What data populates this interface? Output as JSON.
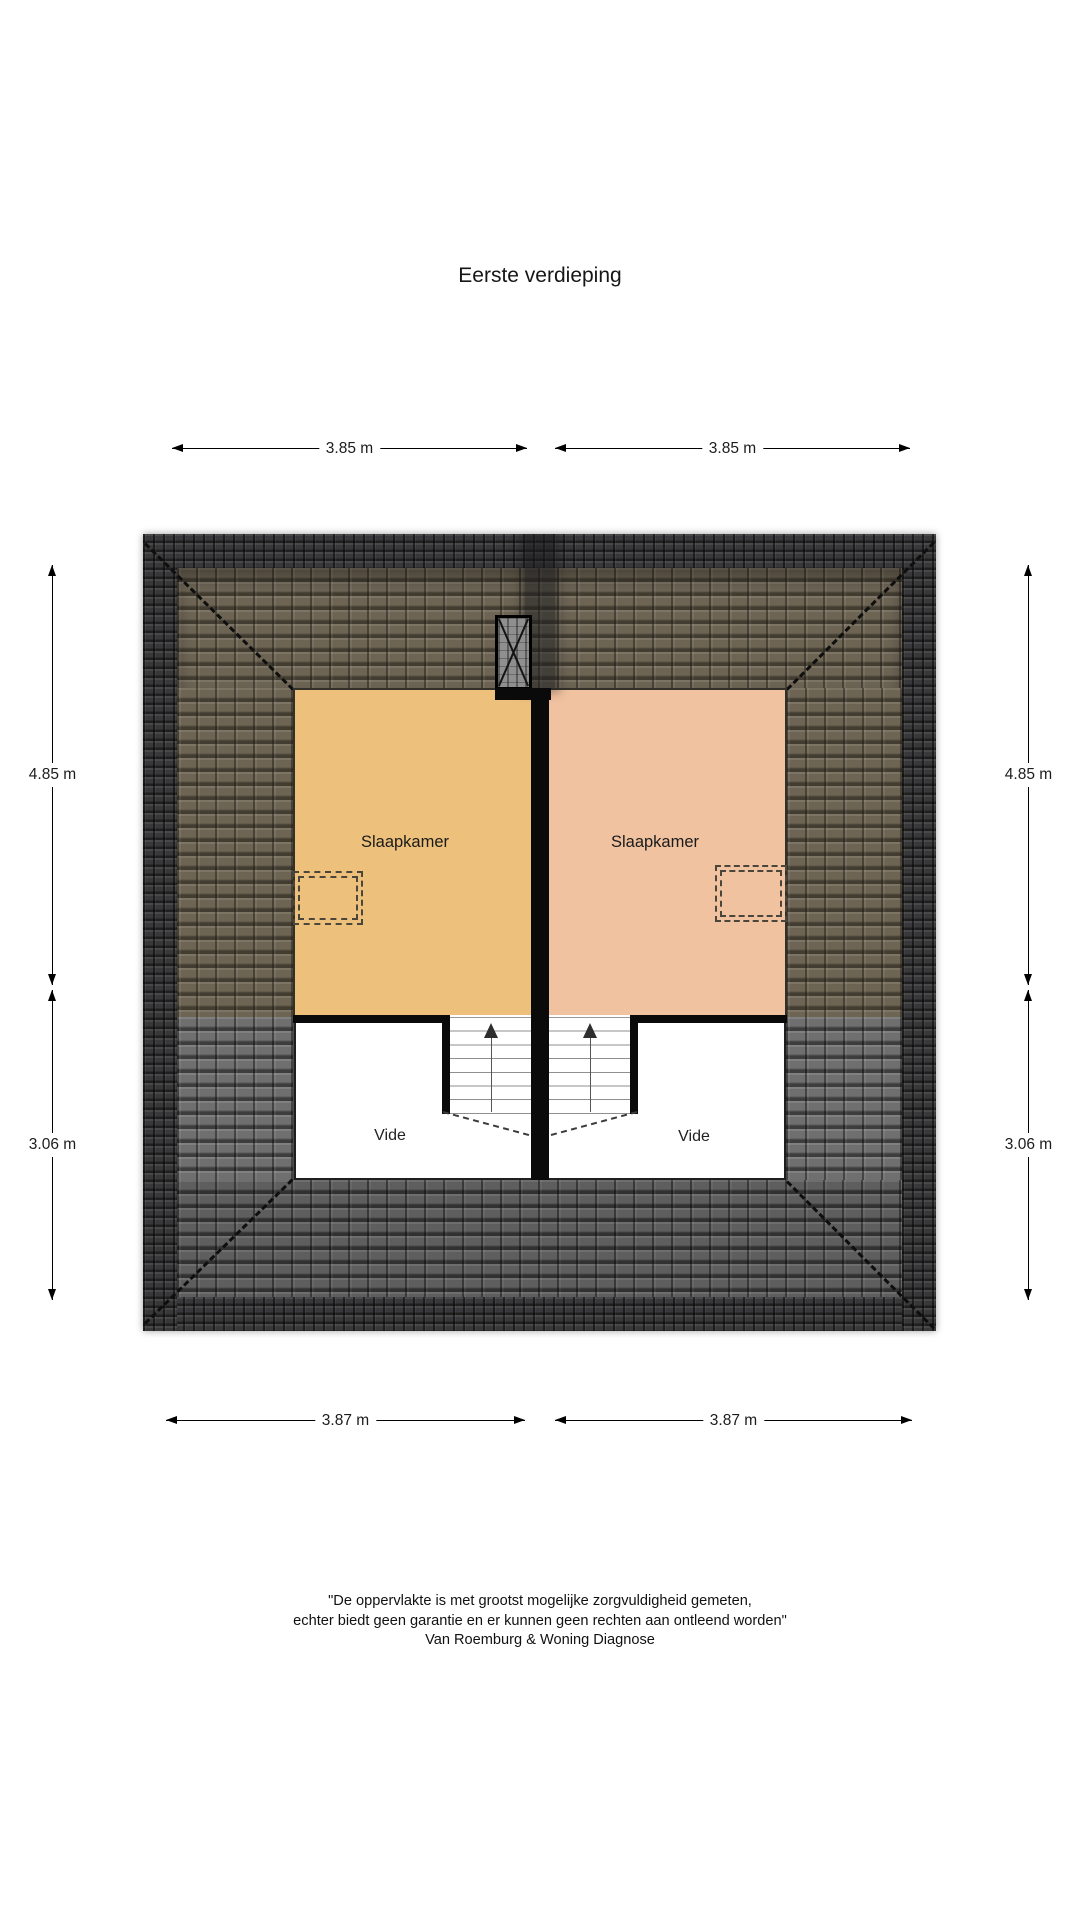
{
  "title": "Eerste verdieping",
  "plan": {
    "rooms": {
      "left": {
        "label": "Slaapkamer",
        "color": "#edc07c"
      },
      "right": {
        "label": "Slaapkamer",
        "color": "#f1c2a0"
      }
    },
    "vides": {
      "left": {
        "label": "Vide"
      },
      "right": {
        "label": "Vide"
      }
    }
  },
  "dimensions": {
    "top_left": "3.85 m",
    "top_right": "3.85 m",
    "bottom_left": "3.87 m",
    "bottom_right": "3.87 m",
    "left_upper": "4.85 m",
    "left_lower": "3.06 m",
    "right_upper": "4.85 m",
    "right_lower": "3.06 m"
  },
  "footer": {
    "line1": "\"De oppervlakte is met grootst mogelijke zorgvuldigheid gemeten,",
    "line2": "echter biedt geen garantie en er kunnen geen rechten aan ontleend worden\"",
    "line3": "Van Roemburg & Woning Diagnose"
  },
  "colors": {
    "bedroom_left": "#edc07c",
    "bedroom_right": "#f1c2a0",
    "roof_front_slope": "#6d6454",
    "roof_back_slope": "#5e5e5e",
    "roof_side_slope": "#6f6f6f",
    "roof_edge_band": "#38383a",
    "wall": "#0a0a0a",
    "background": "#ffffff"
  }
}
